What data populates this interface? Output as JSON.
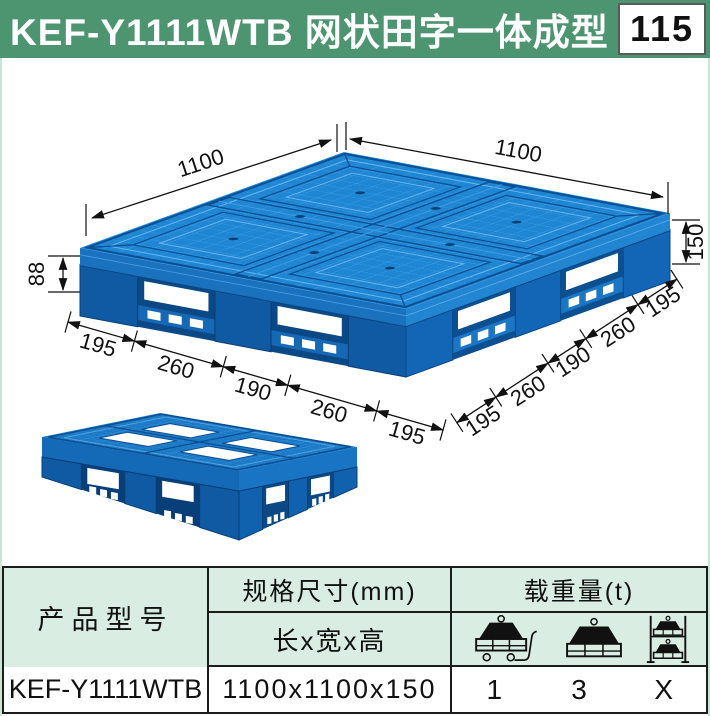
{
  "header": {
    "title": "KEF-Y1111WTB 网状田字一体成型",
    "page_number": "115"
  },
  "diagram": {
    "dim_top_left": "1100",
    "dim_top_right": "1100",
    "dim_height": "150",
    "dim_fork_height": "88",
    "front_edge_segments": [
      "195",
      "260",
      "190",
      "260",
      "195"
    ],
    "right_edge_segments": [
      "195",
      "260",
      "190",
      "260",
      "195"
    ]
  },
  "table": {
    "product_header": "产品型号",
    "size_header": "规格尺寸(mm)",
    "size_sub_header": "长x宽x高",
    "load_header": "载重量(t)",
    "load_icons": [
      "dynamic-load-icon",
      "static-load-icon",
      "racking-load-icon"
    ],
    "row": {
      "model": "KEF-Y1111WTB",
      "size": "1100x1100x150",
      "dynamic_load": "1",
      "static_load": "3",
      "racking_load": "X"
    }
  },
  "colors": {
    "header_green": "#4d9570",
    "table_green": "#d9ede2",
    "pallet_blue": "#1f86d3",
    "dimension_black": "#111111"
  }
}
